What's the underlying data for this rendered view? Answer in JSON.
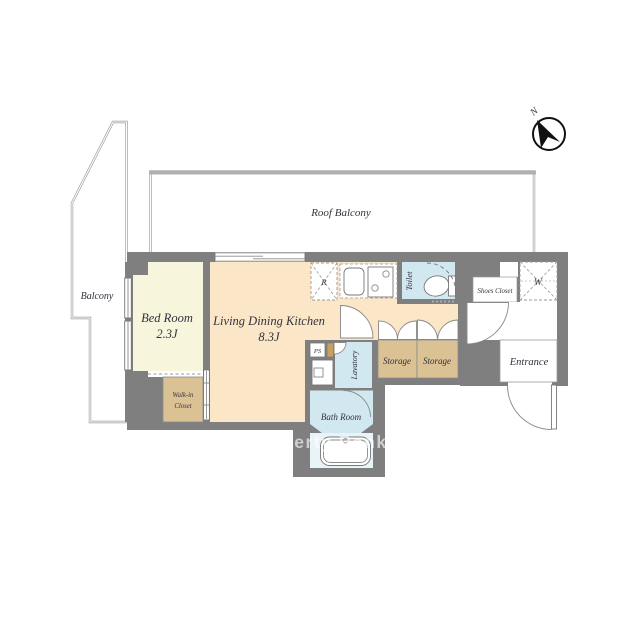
{
  "floorplan": {
    "watermark": "Property Bank",
    "compass": {
      "north": "N"
    },
    "outdoor": {
      "roof_balcony": "Roof Balcony",
      "balcony": "Balcony"
    },
    "rooms": {
      "bed_room": {
        "name": "Bed Room",
        "size": "2.3J"
      },
      "living_dining_kitchen": {
        "name": "Living Dining Kitchen",
        "size": "8.3J"
      },
      "walk_in_closet": {
        "line1": "Walk-in",
        "line2": "Closet"
      },
      "toilet": {
        "name": "Toilet"
      },
      "lavatory": {
        "name": "Lavatory"
      },
      "bath_room": {
        "name": "Bath Room"
      },
      "entrance": {
        "name": "Entrance"
      },
      "shoes_closet": {
        "name": "Shoes Closet"
      },
      "closet_w": {
        "name": "W"
      },
      "storage_left": {
        "name": "Storage"
      },
      "storage_right": {
        "name": "Storage"
      },
      "pipe_space": {
        "name": "PS"
      },
      "refrigerator": {
        "name": "R"
      }
    },
    "colors": {
      "wall": "#7f7f7f",
      "bedroom_fill": "#f8f5dd",
      "ldk_fill": "#fbe7c8",
      "closet_fill": "#dbc294",
      "wet_area_fill": "#d2e8f1",
      "tub_area_fill": "#e9f4f9",
      "meter_box_fill": "#c9a05e",
      "railing": "#9a9a9a",
      "roof_balcony_edge": "#b0b0b0",
      "label_color": "#32323c"
    }
  }
}
